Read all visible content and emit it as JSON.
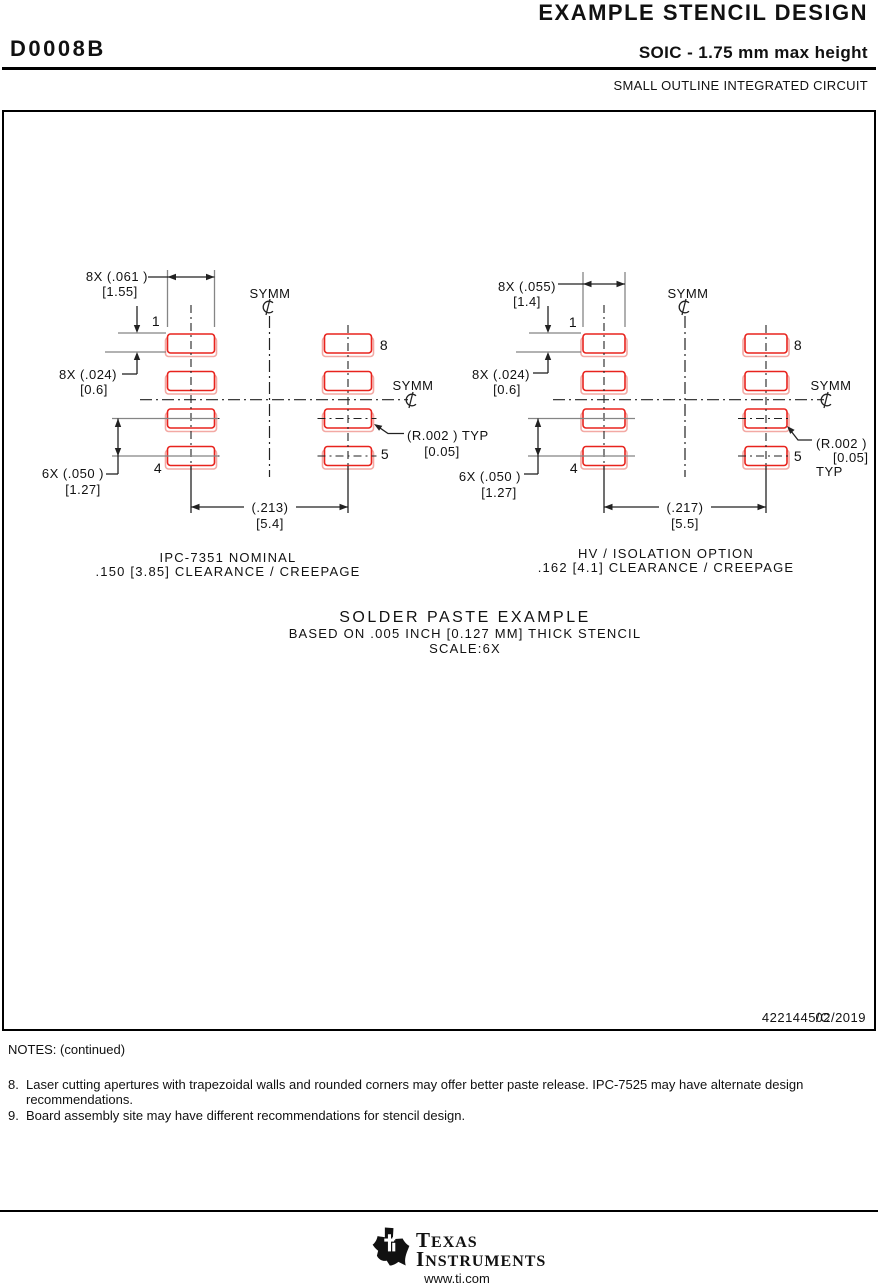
{
  "colors": {
    "pad_red": "#e8231d",
    "pad_pink": "#f3a9a4",
    "line_gray": "#858585",
    "line_black": "#222222"
  },
  "header": {
    "doc_title": "EXAMPLE STENCIL DESIGN",
    "part_id": "D0008B",
    "package_title": "SOIC - 1.75 mm max height",
    "package_subtitle": "SMALL OUTLINE INTEGRATED CIRCUIT"
  },
  "stencil_left": {
    "symm_top": "SYMM",
    "symm_side": "SYMM",
    "dim_pad_width": "8X (.061 )",
    "dim_pad_width_mm": "[1.55]",
    "dim_pad_gap": "8X (.024)",
    "dim_pad_gap_mm": "[0.6]",
    "dim_pitch": "6X (.050 )",
    "dim_pitch_mm": "[1.27]",
    "dim_span": "(.213)",
    "dim_span_mm": "[5.4]",
    "radius": "(R.002 ) TYP",
    "radius_mm": "[0.05]",
    "pin_1": "1",
    "pin_4": "4",
    "pin_5": "5",
    "pin_8": "8",
    "caption_1": "IPC-7351 NOMINAL",
    "caption_2": ".150 [3.85] CLEARANCE / CREEPAGE"
  },
  "stencil_right": {
    "symm_top": "SYMM",
    "symm_side": "SYMM",
    "dim_pad_width": "8X (.055)",
    "dim_pad_width_mm": "[1.4]",
    "dim_pad_gap": "8X (.024)",
    "dim_pad_gap_mm": "[0.6]",
    "dim_pitch": "6X (.050 )",
    "dim_pitch_mm": "[1.27]",
    "dim_span": "(.217)",
    "dim_span_mm": "[5.5]",
    "radius": "(R.002 )",
    "radius_mm": "[0.05]",
    "radius_typ": "TYP",
    "pin_1": "1",
    "pin_4": "4",
    "pin_5": "5",
    "pin_8": "8",
    "caption_1": "HV / ISOLATION OPTION",
    "caption_2": ".162 [4.1] CLEARANCE / CREEPAGE"
  },
  "solder_note": {
    "line1": "SOLDER PASTE EXAMPLE",
    "line2": "BASED ON .005 INCH [0.127 MM] THICK STENCIL",
    "line3": "SCALE:6X"
  },
  "title_block": {
    "drawing_number": "4221445/C",
    "date": "02/2019"
  },
  "notes": {
    "heading": "NOTES: (continued)",
    "items": [
      {
        "num": "8.",
        "text": "Laser cutting apertures with trapezoidal walls and rounded corners may offer better paste release. IPC-7525 may have alternate design recommendations."
      },
      {
        "num": "9.",
        "text": "Board assembly site may have different recommendations for stencil design."
      }
    ]
  },
  "footer": {
    "brand_1": "TEXAS",
    "brand_2": "INSTRUMENTS",
    "url": "www.ti.com"
  }
}
